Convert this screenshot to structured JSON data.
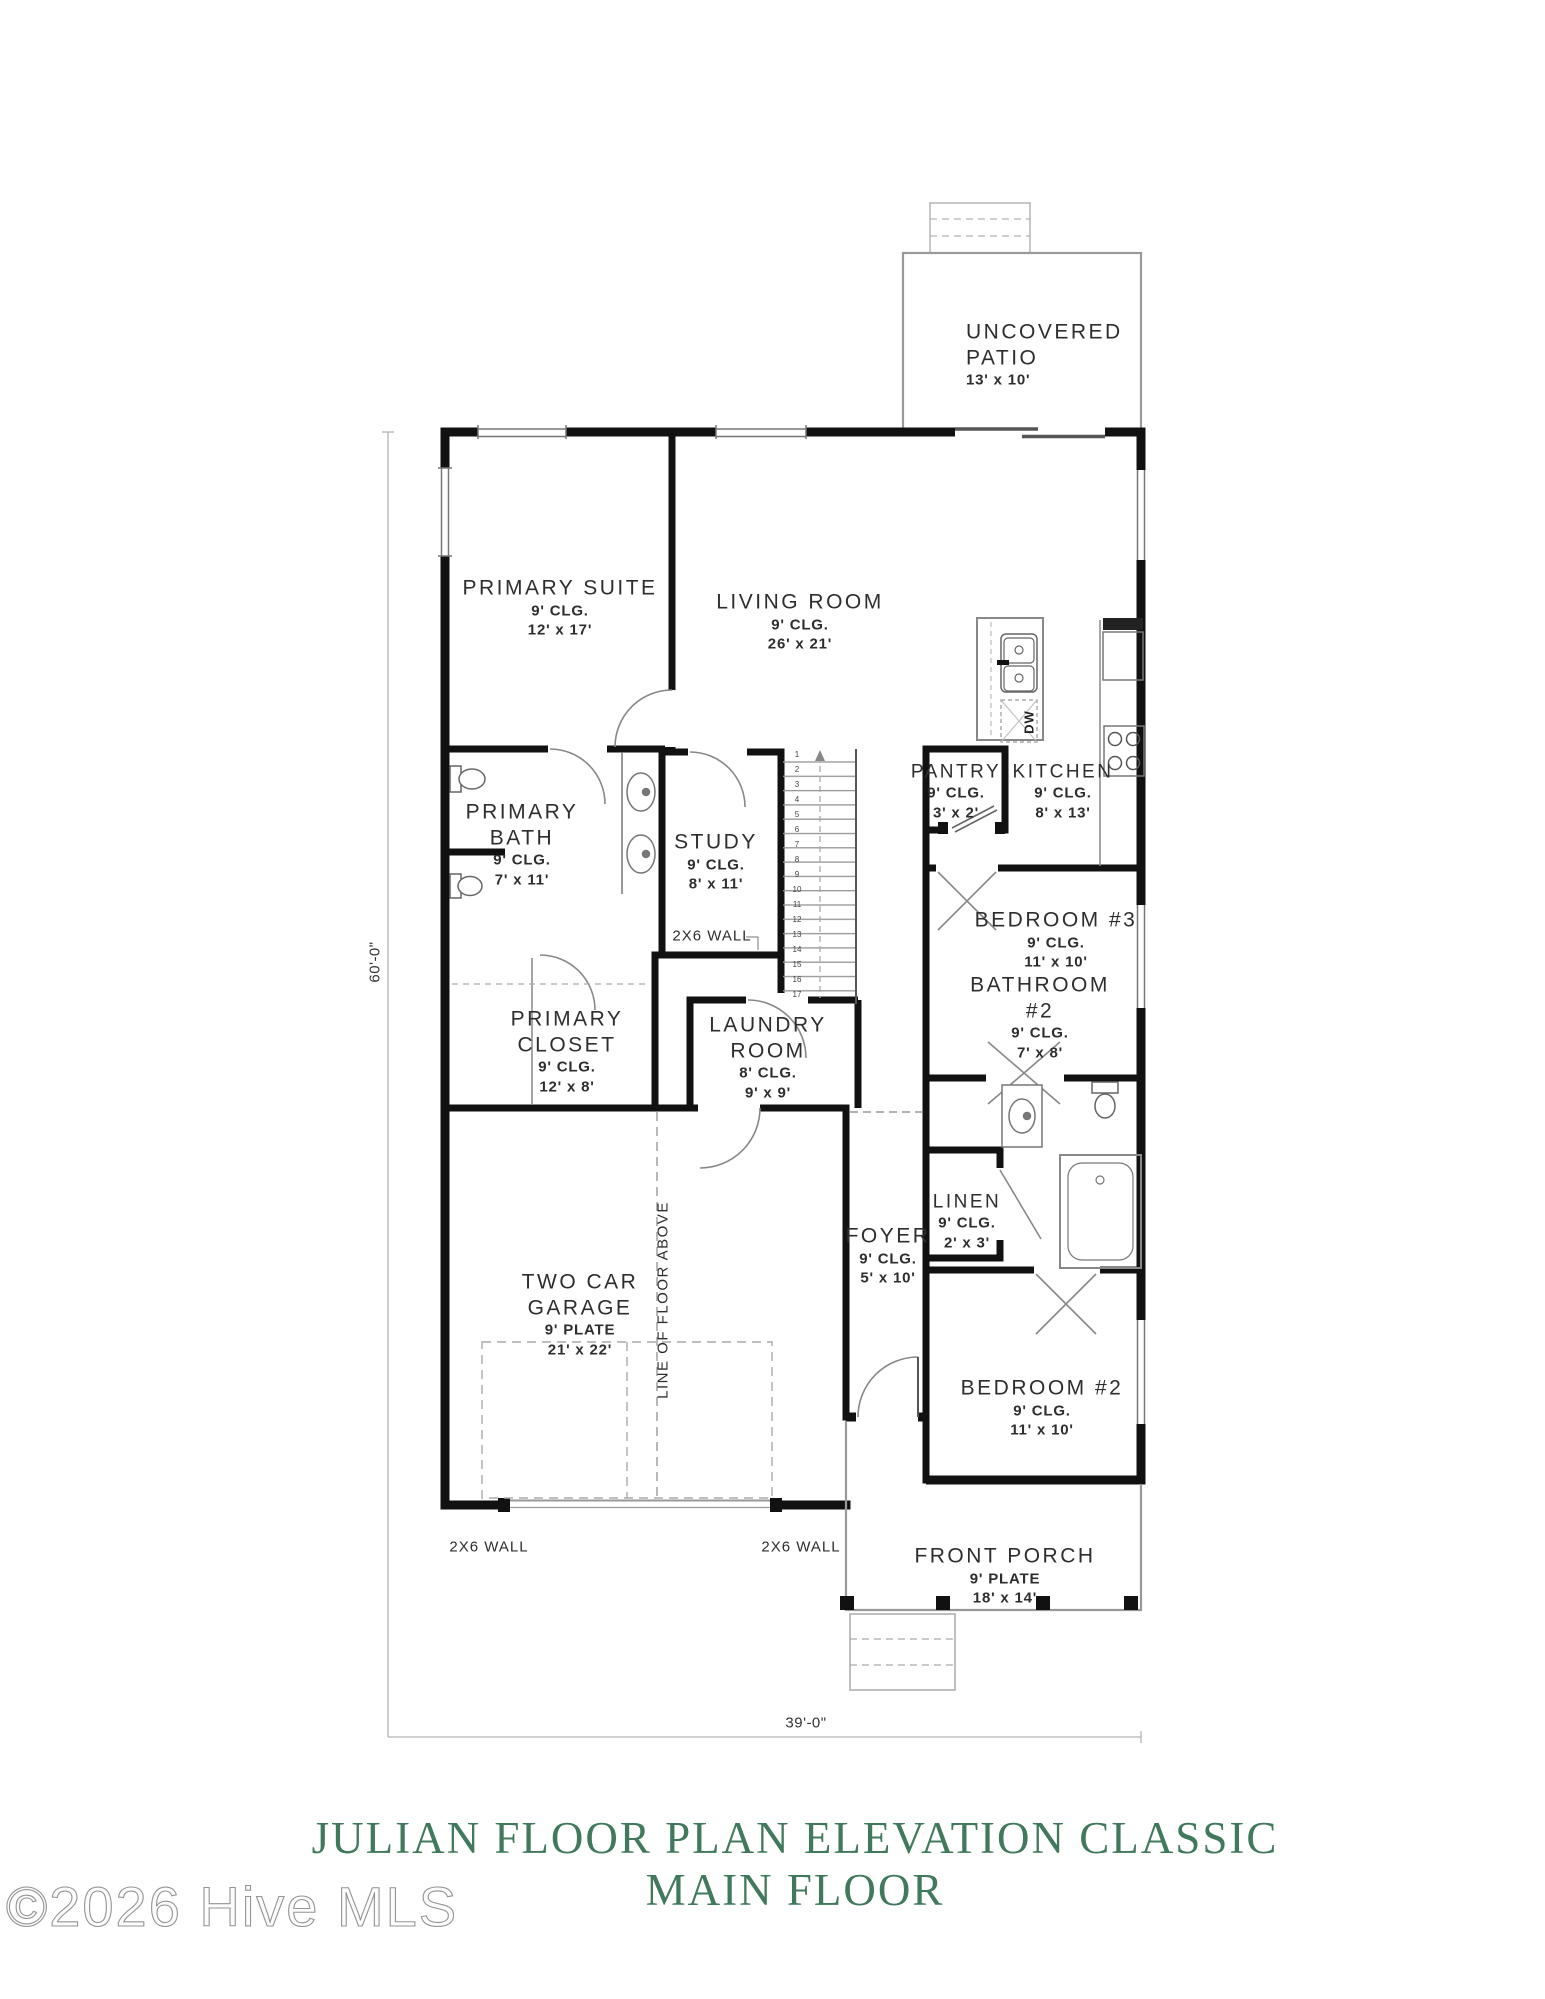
{
  "page": {
    "title_line1": "JULIAN FLOOR PLAN ELEVATION CLASSIC",
    "title_line2": "MAIN FLOOR",
    "title_color": "#40795c",
    "watermark": "©2026 Hive MLS"
  },
  "rooms": {
    "patio": {
      "name": "UNCOVERED\nPATIO",
      "size": "13' x 10'"
    },
    "primary_suite": {
      "name": "PRIMARY SUITE",
      "ceiling": "9' CLG.",
      "size": "12' x 17'"
    },
    "living_room": {
      "name": "LIVING ROOM",
      "ceiling": "9' CLG.",
      "size": "26' x 21'"
    },
    "pantry": {
      "name": "PANTRY",
      "ceiling": "9' CLG.",
      "size": "3' x 2'"
    },
    "kitchen": {
      "name": "KITCHEN",
      "ceiling": "9' CLG.",
      "size": "8' x 13'"
    },
    "primary_bath": {
      "name": "PRIMARY\nBATH",
      "ceiling": "9' CLG.",
      "size": "7' x 11'"
    },
    "study": {
      "name": "STUDY",
      "ceiling": "9' CLG.",
      "size": "8' x 11'"
    },
    "bedroom3": {
      "name": "BEDROOM #3",
      "ceiling": "9' CLG.",
      "size": "11' x 10'"
    },
    "bathroom2": {
      "name": "BATHROOM\n#2",
      "ceiling": "9' CLG.",
      "size": "7' x 8'"
    },
    "primary_closet": {
      "name": "PRIMARY\nCLOSET",
      "ceiling": "9' CLG.",
      "size": "12' x 8'"
    },
    "laundry": {
      "name": "LAUNDRY\nROOM",
      "ceiling": "8' CLG.",
      "size": "9' x 9'"
    },
    "foyer": {
      "name": "FOYER",
      "ceiling": "9' CLG.",
      "size": "5' x 10'"
    },
    "linen": {
      "name": "LINEN",
      "ceiling": "9' CLG.",
      "size": "2' x 3'"
    },
    "garage": {
      "name": "TWO CAR\nGARAGE",
      "ceiling": "9' PLATE",
      "size": "21' x 22'"
    },
    "bedroom2": {
      "name": "BEDROOM #2",
      "ceiling": "9' CLG.",
      "size": "11' x 10'"
    },
    "front_porch": {
      "name": "FRONT PORCH",
      "ceiling": "9' PLATE",
      "size": "18' x 14'"
    }
  },
  "annotations": {
    "dim_height": "60'-0\"",
    "dim_width": "39'-0\"",
    "wall_note_study": "2X6 WALL",
    "wall_note_garage_left": "2X6 WALL",
    "wall_note_garage_right": "2X6 WALL",
    "line_of_floor_above": "LINE OF FLOOR ABOVE",
    "dishwasher": "DW"
  },
  "stairs": {
    "treads": [
      "1",
      "2",
      "3",
      "4",
      "5",
      "6",
      "7",
      "8",
      "9",
      "10",
      "11",
      "12",
      "13",
      "14",
      "15",
      "16",
      "17"
    ]
  }
}
